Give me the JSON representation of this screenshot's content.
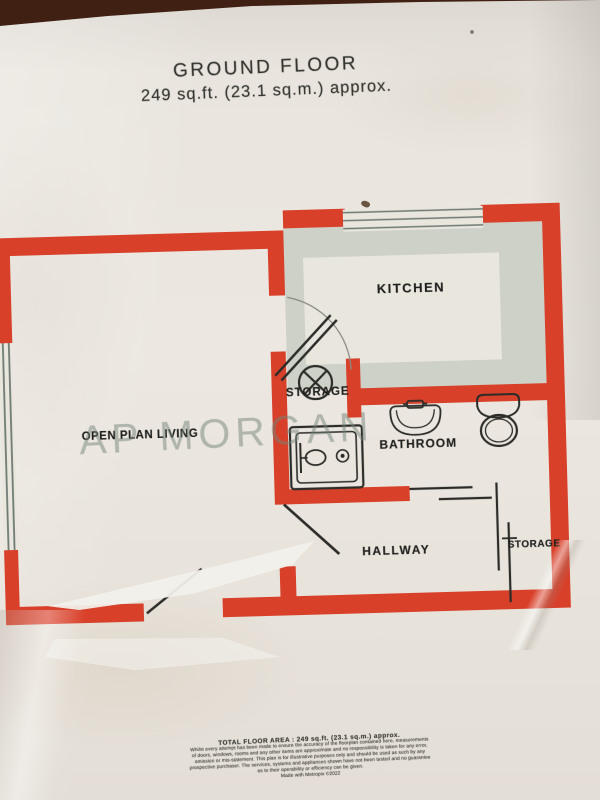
{
  "photo": {
    "background_surface_color": "#3f2013",
    "paper_color": "#e9e5de"
  },
  "title": {
    "line1": "GROUND FLOOR",
    "line2": "249 sq.ft. (23.1 sq.m.) approx."
  },
  "watermark": "AP MORGAN",
  "plan": {
    "wall_color": "#d8402a",
    "counter_color": "#cdd1c7",
    "line_color": "#2b2b28",
    "window_line_color": "#6e7a72",
    "rooms": {
      "kitchen": "KITCHEN",
      "storage_center": "STORAGE",
      "open_plan_living": "OPEN PLAN LIVING",
      "bathroom": "BATHROOM",
      "hallway": "HALLWAY",
      "storage_right": "STORAGE"
    },
    "icons": {
      "cylinder": "cylinder-icon",
      "shower": "shower-icon",
      "basin": "basin-icon",
      "toilet": "toilet-icon",
      "door_swing": "door-swing",
      "window": "window-glazing"
    }
  },
  "footer": {
    "area_line": "TOTAL FLOOR AREA : 249 sq.ft. (23.1 sq.m.) approx.",
    "disclaimer_lines": [
      "Whilst every attempt has been made to ensure the accuracy of the floorplan contained here, measurements",
      "of doors, windows, rooms and any other items are approximate and no responsibility is taken for any error,",
      "omission or mis-statement. This plan is for illustrative purposes only and should be used as such by any",
      "prospective purchaser. The services, systems and appliances shown have not been tested and no guarantee",
      "as to their operability or efficiency can be given.",
      "Made with Metropix ©2022"
    ]
  }
}
